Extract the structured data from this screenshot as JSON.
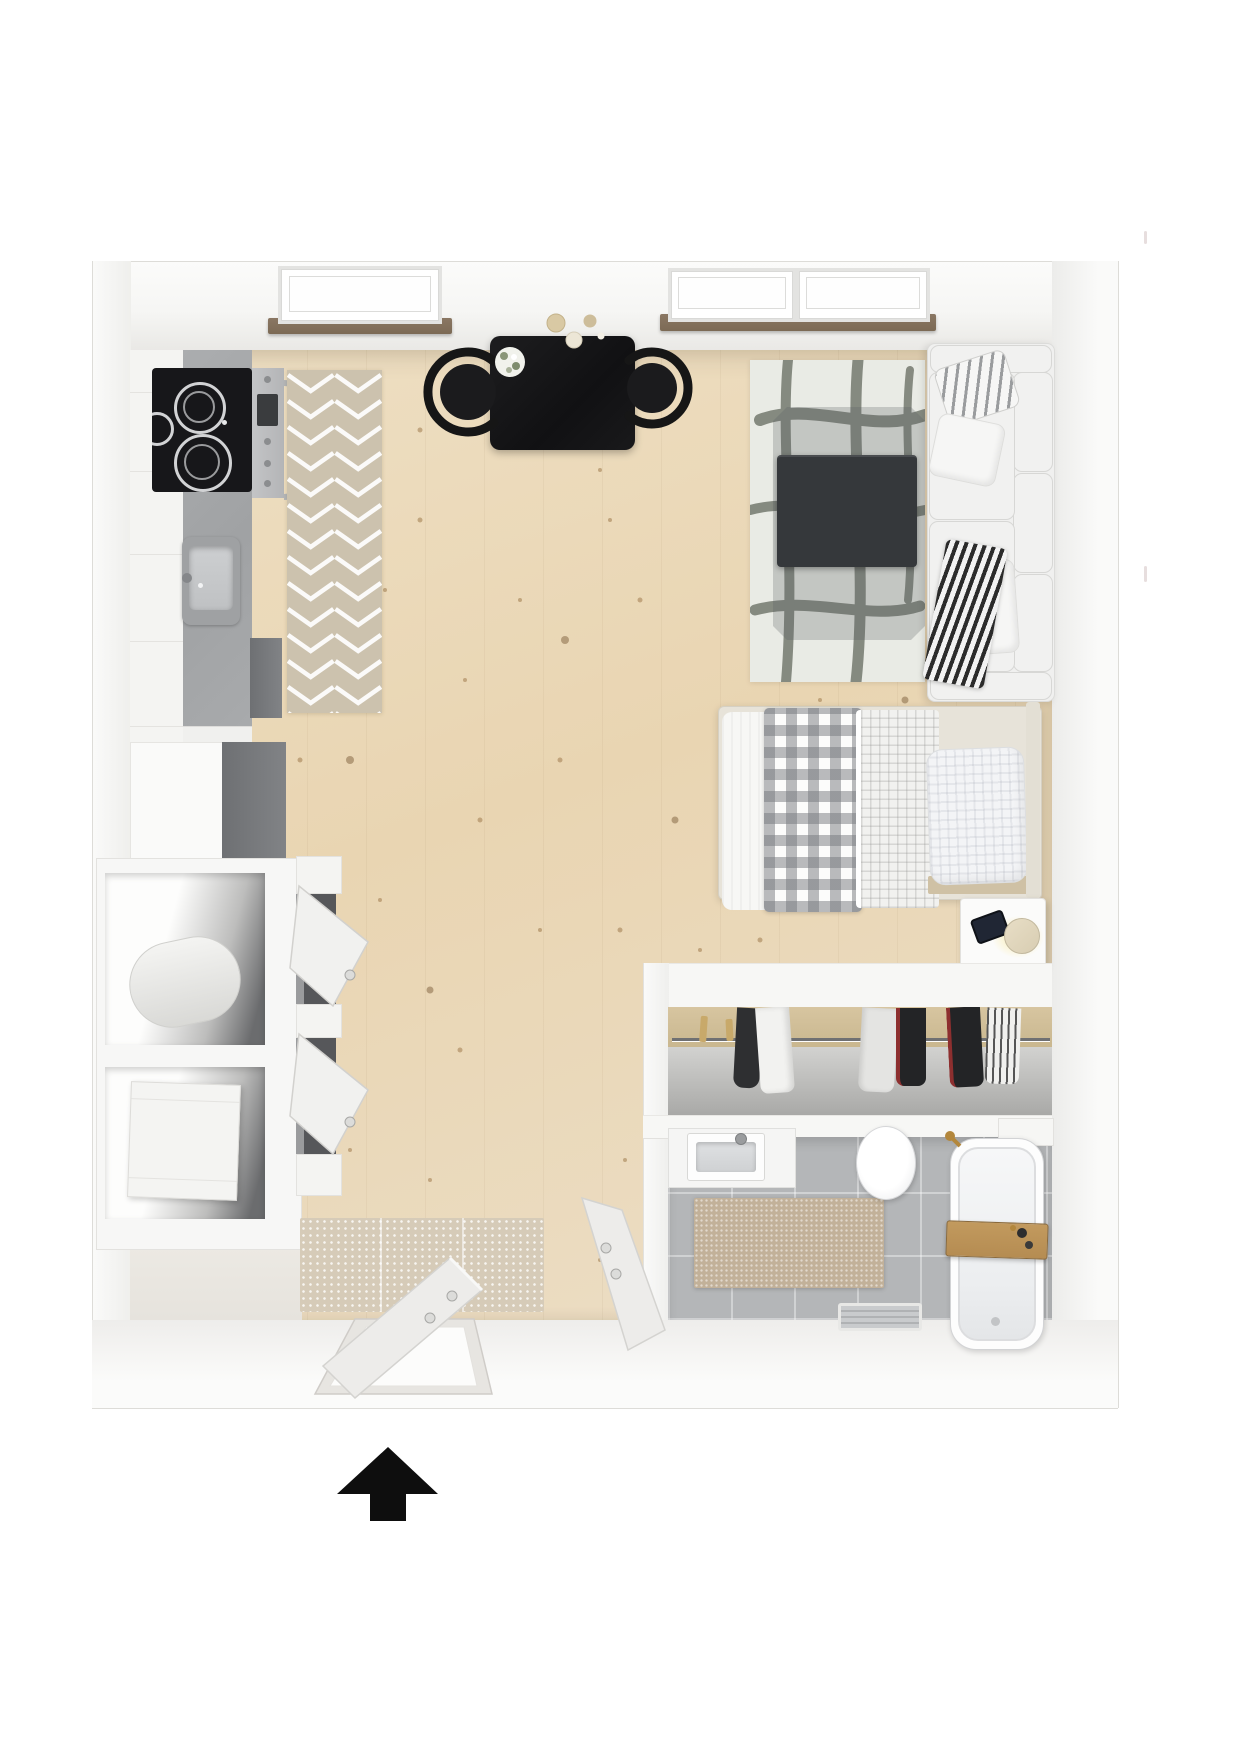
{
  "colors": {
    "wall": "#f8f8f6",
    "wall-shade": "#ebeae7",
    "wall-edge": "#dddcd8",
    "wood": "#e9d5b2",
    "counter": "#a0a2a4",
    "black-appliance": "#17171a",
    "steel": "#b4b5b7",
    "runner-rug": "#ccc2ae",
    "living-rug": "#e9ebe5",
    "rug-stroke": "#6d7267",
    "coffee-table": "#35383b",
    "sofa": "#f0f0ef",
    "cushion-edge": "#d7d7d5",
    "sill": "#7c6a55",
    "tile": "#b4b6b8",
    "bath-mat": "#c2b199",
    "door-mat": "#d6cbb8",
    "wardrobe-wood": "#d7c5a0",
    "dark-opening": "#56575a",
    "appliance-side": "#818386",
    "lamp-body": "#d8cdb2",
    "tray": "#b58c52",
    "gold": "#b3873c",
    "arrow": "#0e0e0e",
    "stray-mark": "#e7dede"
  },
  "indicator": {
    "entrance_arrow": {
      "direction": "up",
      "color": "#0e0e0e"
    }
  },
  "objects": {
    "kitchen": [
      "stove-cooktop",
      "oven-handle",
      "sink",
      "counter",
      "runner-rug",
      "refrigerator"
    ],
    "dining": [
      "black-table",
      "two-chairs",
      "flower-bouquet",
      "plates"
    ],
    "living": [
      "area-rug",
      "coffee-table",
      "sofa",
      "pillows",
      "striped-throw"
    ],
    "sleeping": [
      "single-bed",
      "gingham-duvet",
      "folded-duvet",
      "pillow",
      "nightstand",
      "lamp",
      "phone"
    ],
    "wardrobe": [
      "clothes-rail",
      "hanging-garments",
      "hangers"
    ],
    "bathroom": [
      "vanity-sink",
      "toilet",
      "bathtub",
      "wooden-tray",
      "bath-mat",
      "drain-tray",
      "gold-faucet"
    ],
    "entry": [
      "storage-cubes",
      "tilting-shoe-cabinet",
      "doormat",
      "entry-door",
      "bathroom-door"
    ],
    "windows": [
      "skylight-kitchen",
      "skylight-living-left",
      "skylight-living-right",
      "window-sills"
    ]
  }
}
